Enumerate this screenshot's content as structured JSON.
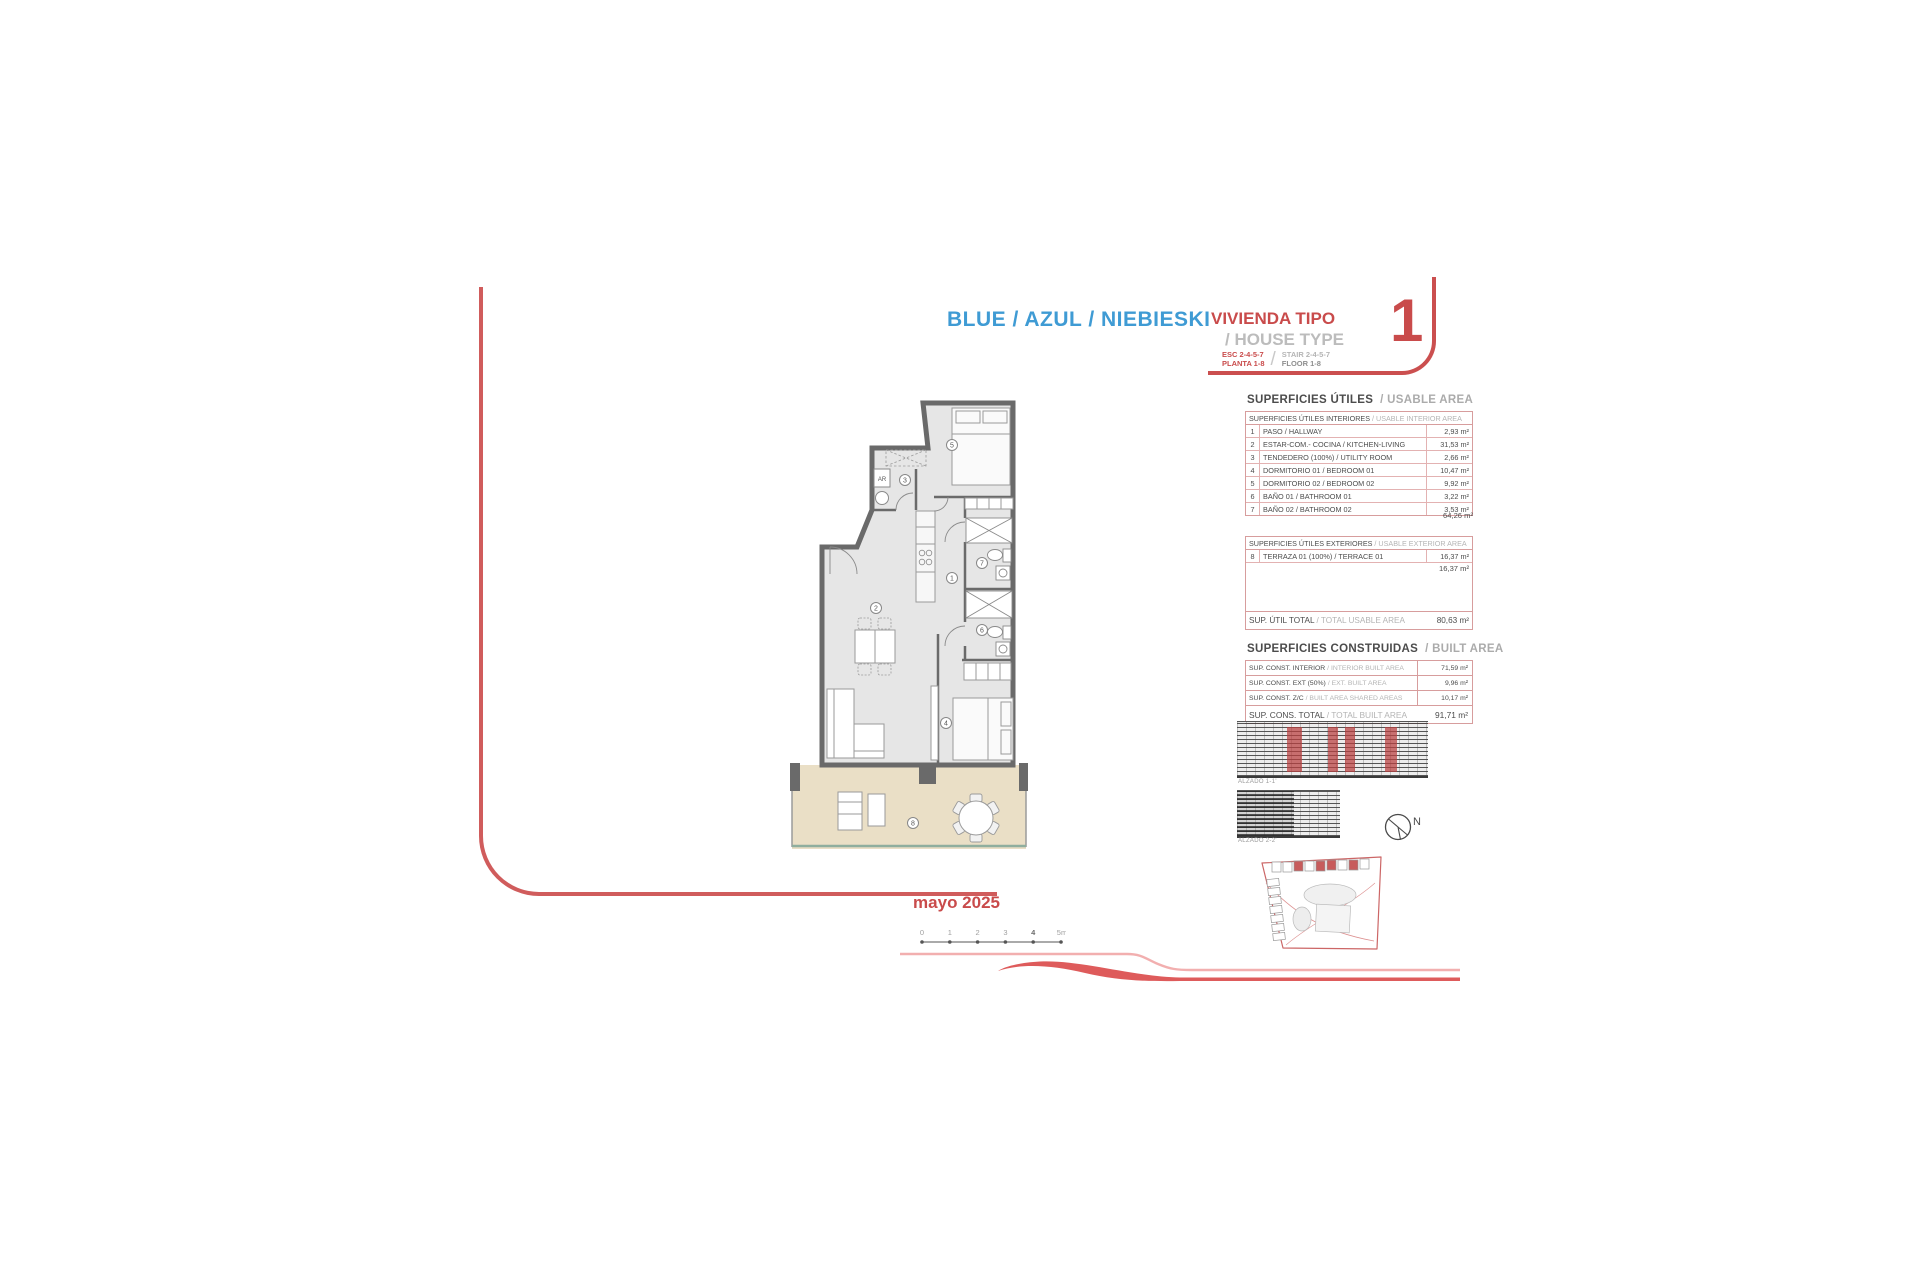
{
  "title": {
    "names": "BLUE / AZUL / NIEBIESKI",
    "vivienda_tipo": "VIVIENDA TIPO",
    "house_type": "/ HOUSE TYPE",
    "esc": "ESC 2-4-5-7",
    "planta": "PLANTA 1-8",
    "stair": "STAIR 2-4-5-7",
    "floor": "FLOOR 1-8",
    "slash": "/",
    "type_number": "1"
  },
  "date": "mayo 2025",
  "usable_area": {
    "title_es": "SUPERFICIES ÚTILES",
    "title_en": "/ USABLE AREA",
    "interior": {
      "header_es": "SUPERFICIES ÚTILES INTERIORES",
      "header_en": "/ USABLE INTERIOR AREA",
      "rows": [
        {
          "num": "1",
          "label": "PASO / HALLWAY",
          "value": "2,93 m²"
        },
        {
          "num": "2",
          "label": "ESTAR-COM.- COCINA / KITCHEN-LIVING",
          "value": "31,53 m²"
        },
        {
          "num": "3",
          "label": "TENDEDERO (100%) / UTILITY ROOM",
          "value": "2,66 m²"
        },
        {
          "num": "4",
          "label": "DORMITORIO 01 / BEDROOM 01",
          "value": "10,47 m²"
        },
        {
          "num": "5",
          "label": "DORMITORIO 02 / BEDROOM 02",
          "value": "9,92 m²"
        },
        {
          "num": "6",
          "label": "BAÑO 01 / BATHROOM 01",
          "value": "3,22 m²"
        },
        {
          "num": "7",
          "label": "BAÑO 02 / BATHROOM 02",
          "value": "3,53 m²"
        }
      ],
      "subtotal": "64,26 m²"
    },
    "exterior": {
      "header_es": "SUPERFICIES ÚTILES EXTERIORES",
      "header_en": "/ USABLE EXTERIOR AREA",
      "rows": [
        {
          "num": "8",
          "label": "TERRAZA 01 (100%) / TERRACE 01",
          "value": "16,37 m²"
        }
      ],
      "subtotal": "16,37 m²"
    },
    "total_label_es": "SUP. ÚTIL TOTAL",
    "total_label_en": "/ TOTAL USABLE AREA",
    "total_value": "80,63 m²"
  },
  "built_area": {
    "title_es": "SUPERFICIES CONSTRUIDAS",
    "title_en": "/ BUILT AREA",
    "rows": [
      {
        "label_es": "SUP. CONST. INTERIOR",
        "label_en": "/ INTERIOR BUILT AREA",
        "value": "71,59 m²"
      },
      {
        "label_es": "SUP. CONST. EXT (50%)",
        "label_en": "/ EXT. BUILT AREA",
        "value": "9,96 m²"
      },
      {
        "label_es": "SUP. CONST. Z/C",
        "label_en": "/ BUILT AREA SHARED AREAS",
        "value": "10,17 m²"
      }
    ],
    "total_label_es": "SUP. CONS. TOTAL",
    "total_label_en": "/ TOTAL BUILT AREA",
    "total_value": "91,71 m²"
  },
  "elevations": {
    "label1": "ALZADO 1-1'",
    "label2": "ALZADO 2-2'"
  },
  "compass": {
    "north": "N"
  },
  "scalebar": {
    "ticks": [
      "0",
      "1",
      "2",
      "3",
      "4",
      "5m"
    ]
  },
  "plan": {
    "room_numbers": [
      "1",
      "2",
      "3",
      "4",
      "5",
      "6",
      "7",
      "8"
    ],
    "washer": "AR",
    "watermark": "gp"
  },
  "colors": {
    "title_blue": "#3f9bd4",
    "accent_red": "#c94b4b",
    "table_border": "#d79d9d",
    "terrace_floor": "#eadfc6"
  }
}
